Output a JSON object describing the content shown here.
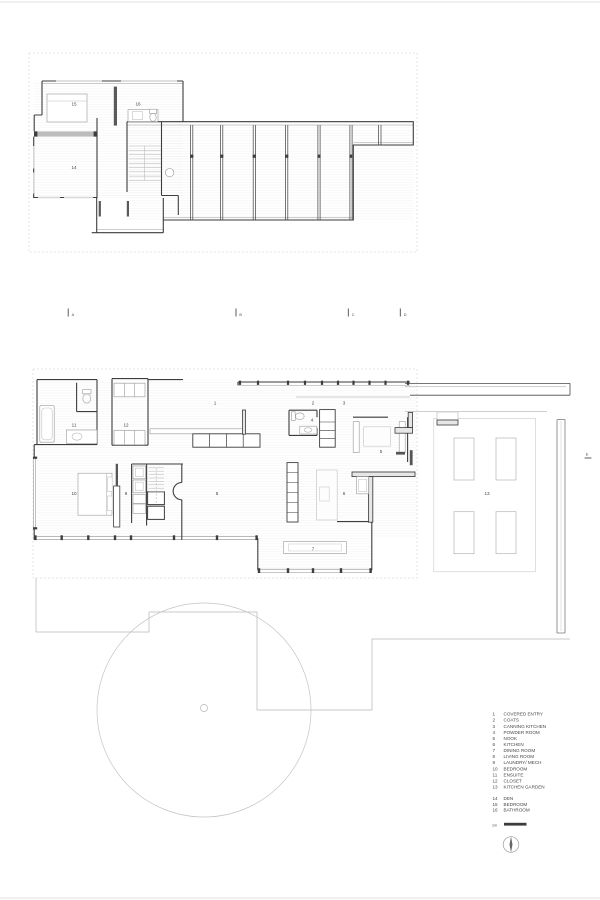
{
  "document_title": "residential floor plan drawing",
  "colors": {
    "background": "#ffffff",
    "wall_dark": "#3d3d3d",
    "line_medium": "#9a9a9a",
    "line_light": "#c8c8c8",
    "text": "#474747"
  },
  "rooms": {
    "r1": "1",
    "r2": "2",
    "r3": "3",
    "r4": "4",
    "r5": "5",
    "r6": "6",
    "r7": "7",
    "r8": "8",
    "r9": "9",
    "r10": "10",
    "r11": "11",
    "r12": "12",
    "r13": "13",
    "r14": "14",
    "r15": "15",
    "r16": "16"
  },
  "sections": {
    "a": "A",
    "b": "B",
    "c": "C",
    "d": "D",
    "e": "E"
  },
  "legend": {
    "ground_floor_items": [
      {
        "number": "1",
        "name": "COVERED ENTRY"
      },
      {
        "number": "2",
        "name": "COATS"
      },
      {
        "number": "3",
        "name": "CANNING KITCHEN"
      },
      {
        "number": "4",
        "name": "POWDER ROOM"
      },
      {
        "number": "5",
        "name": "NOOK"
      },
      {
        "number": "6",
        "name": "KITCHEN"
      },
      {
        "number": "7",
        "name": "DINING ROOM"
      },
      {
        "number": "8",
        "name": "LIVING ROOM"
      },
      {
        "number": "9",
        "name": "LAUNDRY/ MECH"
      },
      {
        "number": "10",
        "name": "BEDROOM"
      },
      {
        "number": "11",
        "name": "ENSUITE"
      },
      {
        "number": "12",
        "name": "CLOSET"
      },
      {
        "number": "13",
        "name": "KITCHEN GARDEN"
      }
    ],
    "upper_floor_items": [
      {
        "number": "14",
        "name": "DEN"
      },
      {
        "number": "15",
        "name": "BEDROOM"
      },
      {
        "number": "16",
        "name": "BATHROOM"
      }
    ]
  },
  "scale_bar": {
    "label": "1m"
  }
}
